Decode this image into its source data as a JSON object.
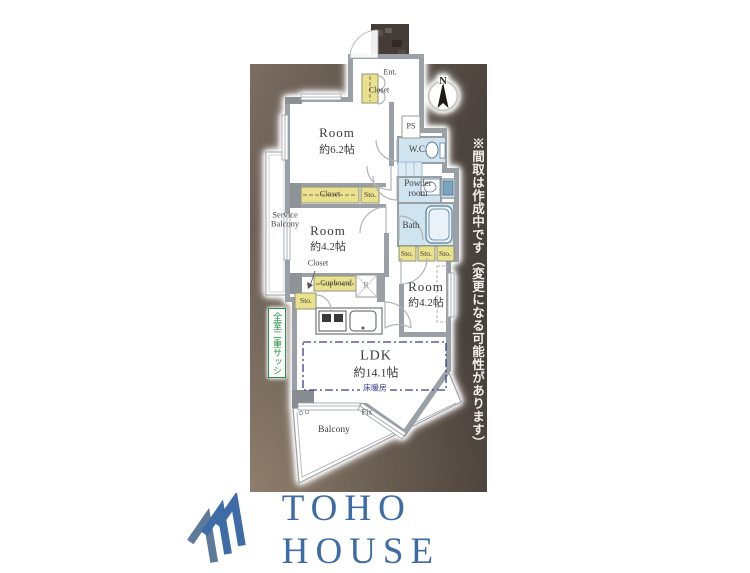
{
  "notice": {
    "text": "※間取は作成中です（変更になる可能性があります）"
  },
  "compass": {
    "label": "N"
  },
  "plan": {
    "entrance": {
      "label": "Ent."
    },
    "closet_entrance": {
      "label": "Closet"
    },
    "ps": {
      "label": "PS"
    },
    "wc": {
      "label": "W.C."
    },
    "powder_room": {
      "label": "Powder room"
    },
    "bath": {
      "label": "Bath"
    },
    "sto_row": [
      "Sto.",
      "Sto.",
      "Sto."
    ],
    "closet_mid": {
      "label": "Closet"
    },
    "sto_mid": {
      "label": "Sto."
    },
    "closet_low": {
      "label": "Closet"
    },
    "cupboard": {
      "label": "Cupboard"
    },
    "refrigerator": {
      "label": "R"
    },
    "sto_low": {
      "label": "Sto."
    },
    "rooms": {
      "bedroom1": {
        "name": "Room",
        "size": "約6.2帖"
      },
      "bedroom2": {
        "name": "Room",
        "size": "約4.2帖"
      },
      "bedroom3": {
        "name": "Room",
        "size": "約4.2帖"
      },
      "ldk": {
        "name": "LDK",
        "size": "約14.1帖"
      }
    },
    "floor_heating": {
      "label": "床暖房"
    },
    "fix": {
      "label": "Fix"
    },
    "balcony": {
      "label": "Balcony"
    },
    "service_balcony": {
      "label": "Service Balcony"
    },
    "double_sash_badge": {
      "label": "全室二重サッシ"
    }
  },
  "footer": {
    "brand": "TOHO HOUSE"
  },
  "colors": {
    "brand_blue": "#3d6ca6",
    "wall_gray": "#9aa0a5",
    "closet_yellow": "#e9e18d",
    "wet_blue": "#cfe4ef",
    "heating_blue": "#3a3e8e",
    "badge_green": "#2a9246"
  }
}
